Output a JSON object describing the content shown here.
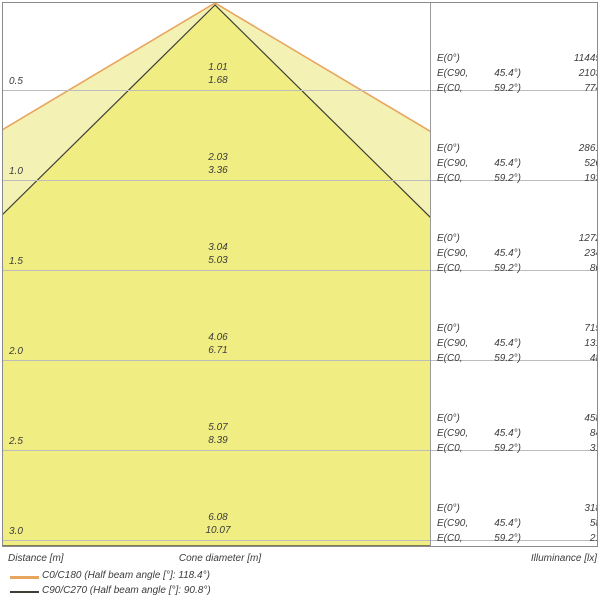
{
  "chart_data": {
    "type": "area",
    "subtype": "light-cone-diagram",
    "axes": {
      "distance_label": "Distance [m]",
      "cone_diameter_label": "Cone diameter [m]",
      "illuminance_label": "Illuminance [lx]"
    },
    "legend": [
      {
        "series": "C0/C180",
        "label": "C0/C180 (Half beam angle [°]: 118.4°)",
        "beam_angle_deg": 118.4,
        "stroke": "#e8a55e",
        "fill": "#f4f1b5"
      },
      {
        "series": "C90/C270",
        "label": "C90/C270 (Half beam angle [°]: 90.8°)",
        "beam_angle_deg": 90.8,
        "stroke": "#3e3e35",
        "fill": "#f0ed83"
      }
    ],
    "e_labels": {
      "e0": "E(0°)",
      "ec90": "E(C90,",
      "ec90_angle": "45.4°)",
      "ec0": "E(C0,",
      "ec0_angle": "59.2°)"
    },
    "rows": [
      {
        "distance_m": "0.5",
        "cone_diameter_m": {
          "c90_c270": "1.01",
          "c0_c180": "1.68"
        },
        "illuminance_lx": {
          "e0": "11445",
          "ec90": "2103",
          "ec0": "774"
        }
      },
      {
        "distance_m": "1.0",
        "cone_diameter_m": {
          "c90_c270": "2.03",
          "c0_c180": "3.36"
        },
        "illuminance_lx": {
          "e0": "2861",
          "ec90": "526",
          "ec0": "193"
        }
      },
      {
        "distance_m": "1.5",
        "cone_diameter_m": {
          "c90_c270": "3.04",
          "c0_c180": "5.03"
        },
        "illuminance_lx": {
          "e0": "1272",
          "ec90": "234",
          "ec0": "86"
        }
      },
      {
        "distance_m": "2.0",
        "cone_diameter_m": {
          "c90_c270": "4.06",
          "c0_c180": "6.71"
        },
        "illuminance_lx": {
          "e0": "715",
          "ec90": "131",
          "ec0": "48"
        }
      },
      {
        "distance_m": "2.5",
        "cone_diameter_m": {
          "c90_c270": "5.07",
          "c0_c180": "8.39"
        },
        "illuminance_lx": {
          "e0": "458",
          "ec90": "84",
          "ec0": "31"
        }
      },
      {
        "distance_m": "3.0",
        "cone_diameter_m": {
          "c90_c270": "6.08",
          "c0_c180": "10.07"
        },
        "illuminance_lx": {
          "e0": "318",
          "ec90": "58",
          "ec0": "21"
        }
      }
    ],
    "layout_hints": {
      "row_step_m": 0.5,
      "grid": "on",
      "legend_position": "bottom-left"
    }
  },
  "colors": {
    "grid": "#bcbcbc",
    "border": "#8a8a8a",
    "text": "#3c3c3c",
    "cone_c0_fill": "#f4f1b5",
    "cone_c0_stroke": "#e8a55e",
    "cone_c90_fill": "#f0ed83",
    "cone_c90_stroke": "#3e3e35"
  }
}
